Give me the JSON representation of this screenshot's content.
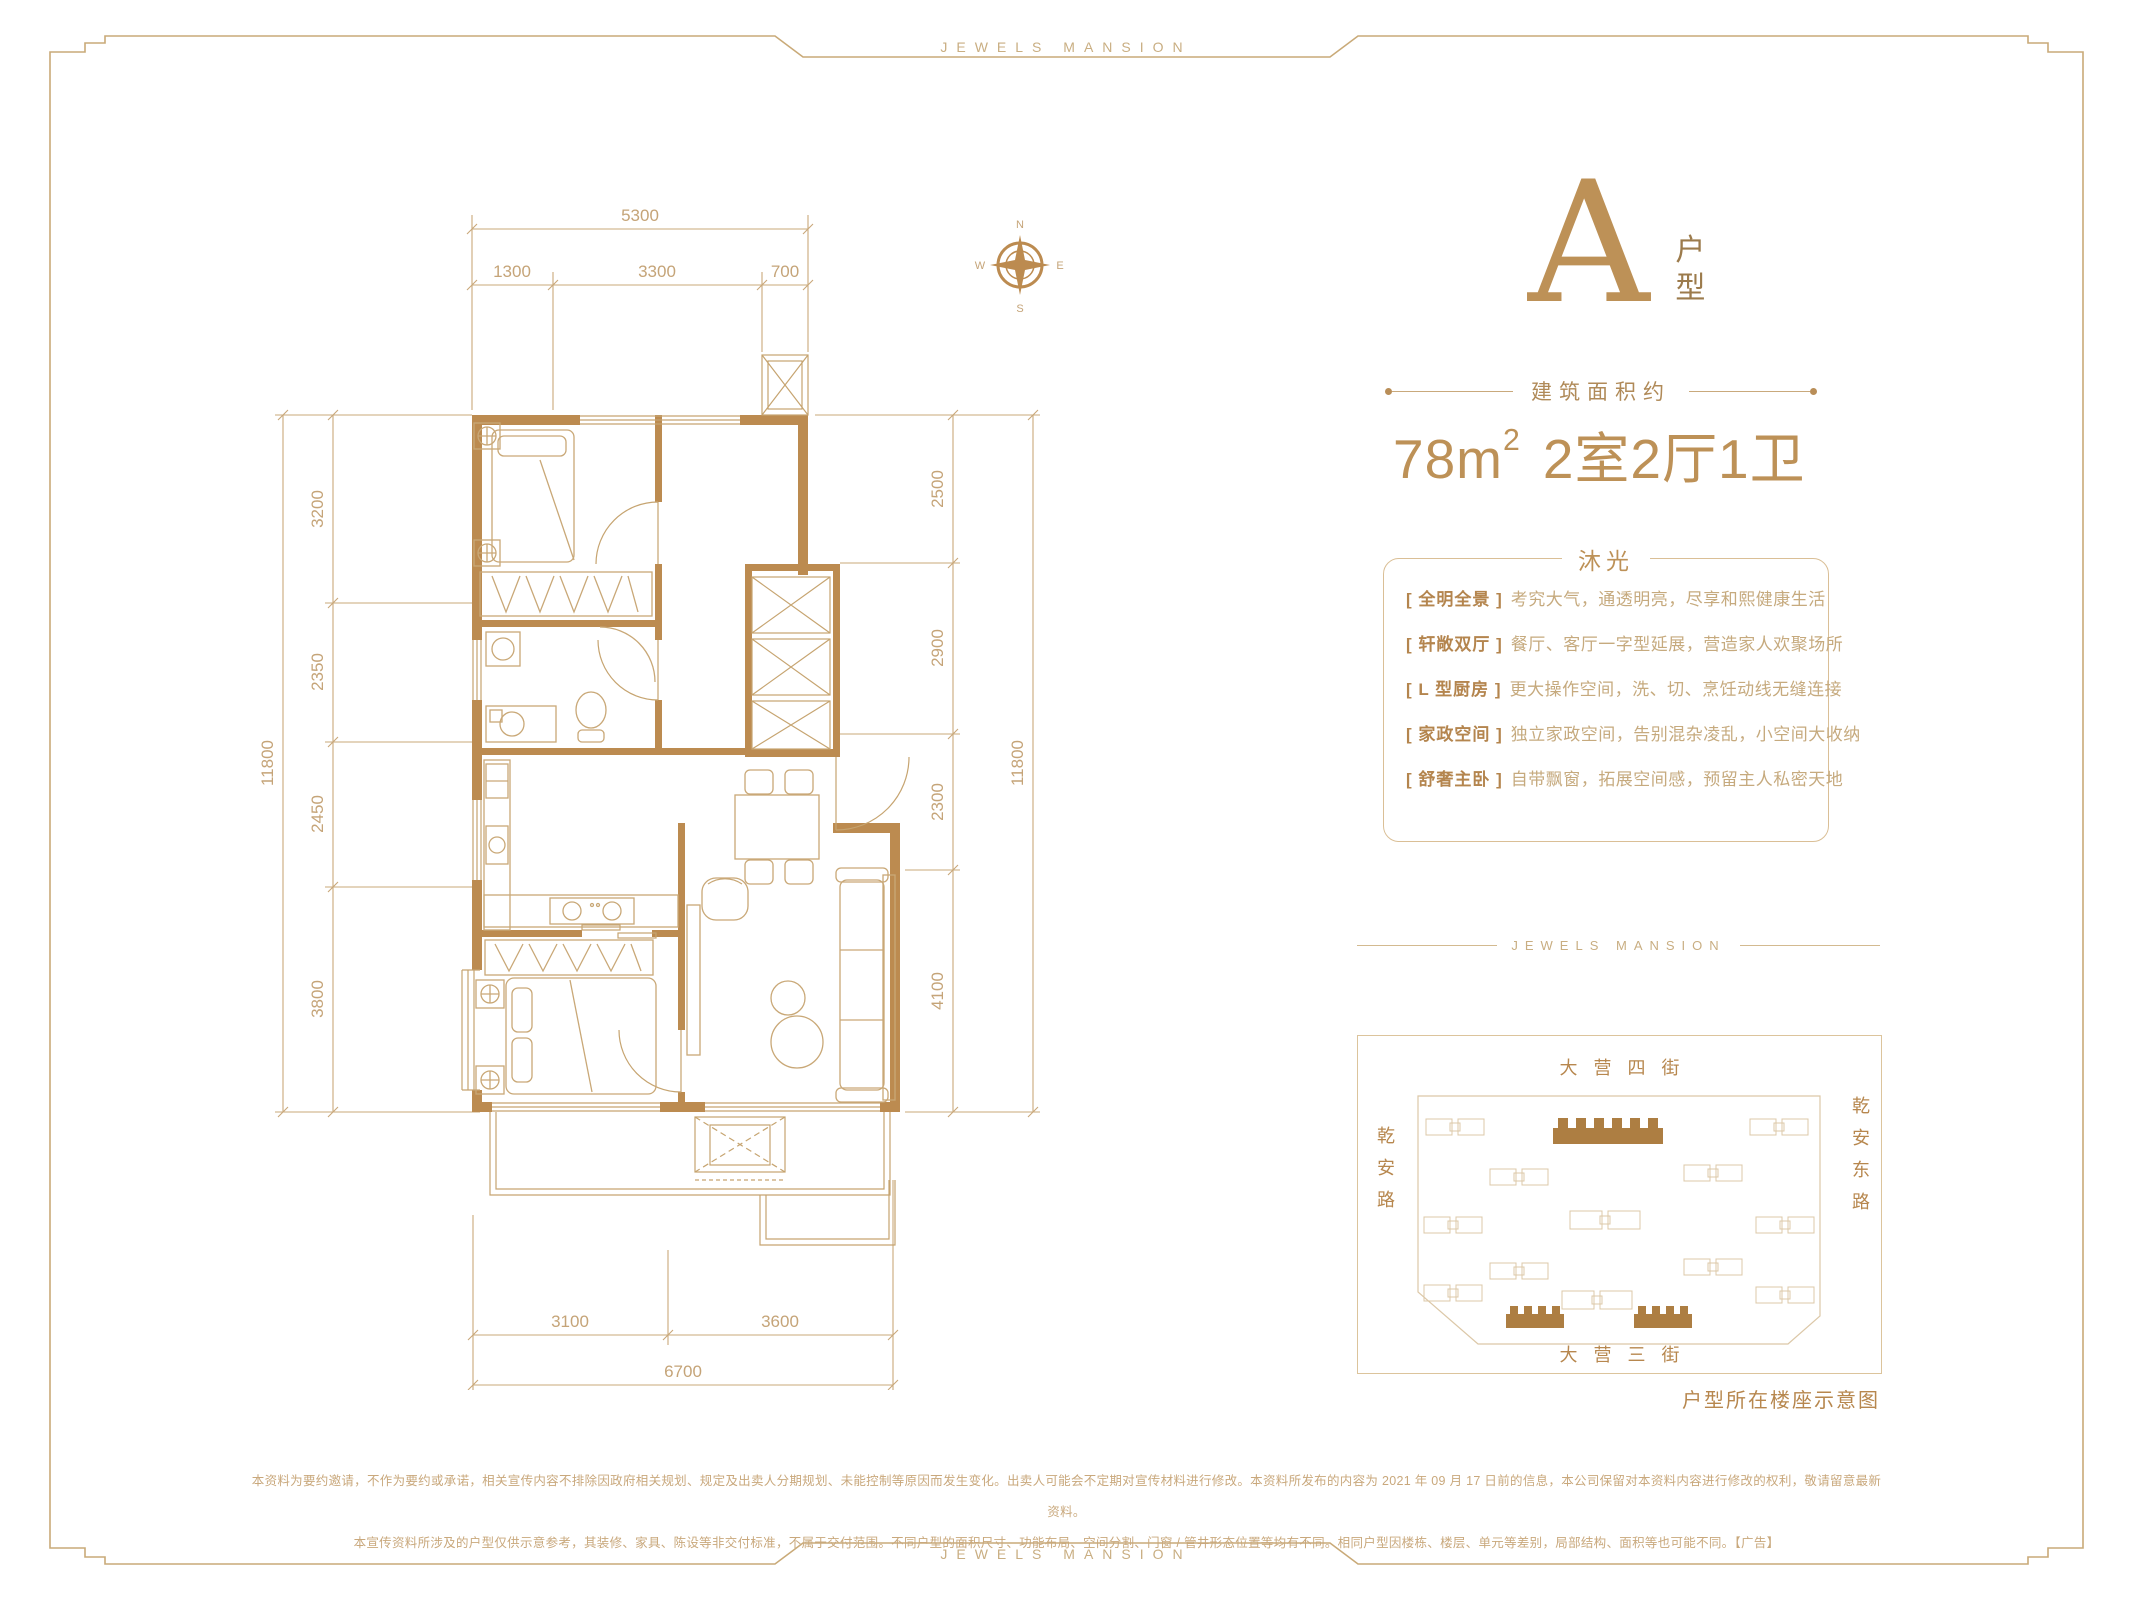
{
  "brand": {
    "top": "JEWELS MANSION",
    "bottom": "JEWELS MANSION"
  },
  "compass": {
    "n": "N",
    "e": "E",
    "s": "S",
    "w": "W"
  },
  "floorplan": {
    "dims_top": {
      "total": "5300",
      "segments": [
        "1300",
        "3300",
        "700"
      ]
    },
    "dims_left": {
      "total": "11800",
      "segments": [
        "3200",
        "2350",
        "2450",
        "3800"
      ]
    },
    "dims_right": {
      "total": "11800",
      "segments": [
        "2500",
        "2900",
        "2300",
        "4100"
      ]
    },
    "dims_bottom": {
      "total": "6700",
      "segments": [
        "3100",
        "3600"
      ]
    }
  },
  "unit": {
    "letter": "A",
    "type_top": "户",
    "type_bottom": "型",
    "area_label": "建筑面积约",
    "area_value": "78m",
    "area_sup": "2",
    "layout_text": "2室2厅1卫"
  },
  "features": {
    "title": "沐光",
    "items": [
      {
        "tag": "[ 全明全景 ]",
        "desc": "考究大气，通透明亮，尽享和熙健康生活"
      },
      {
        "tag": "[ 轩敞双厅 ]",
        "desc": "餐厅、客厅一字型延展，营造家人欢聚场所"
      },
      {
        "tag": "[ L 型厨房 ]",
        "desc": "更大操作空间，洗、切、烹饪动线无缝连接"
      },
      {
        "tag": "[ 家政空间 ]",
        "desc": "独立家政空间，告别混杂凌乱，小空间大收纳"
      },
      {
        "tag": "[ 舒奢主卧 ]",
        "desc": "自带飘窗，拓展空间感，预留主人私密天地"
      }
    ]
  },
  "siteplan": {
    "divider": "JEWELS MANSION",
    "street_top": "大营四街",
    "street_bottom": "大营三街",
    "road_left": "乾安路",
    "road_right": "乾安东路",
    "caption": "户型所在楼座示意图"
  },
  "disclaimer": {
    "line1": "本资料为要约邀请，不作为要约或承诺，相关宣传内容不排除因政府相关规划、规定及出卖人分期规划、未能控制等原因而发生变化。出卖人可能会不定期对宣传材料进行修改。本资料所发布的内容为 2021 年 09 月 17 日前的信息，本公司保留对本资料内容进行修改的权利，敬请留意最新资料。",
    "line2": "本宣传资料所涉及的户型仅供示意参考，其装修、家具、陈设等非交付标准，不属于交付范围。不同户型的面积尺寸、功能布局、空间分割、门窗 / 管井形态位置等均有不同。相同户型因楼栋、楼层、单元等差别，局部结构、面积等也可能不同。【广告】"
  }
}
